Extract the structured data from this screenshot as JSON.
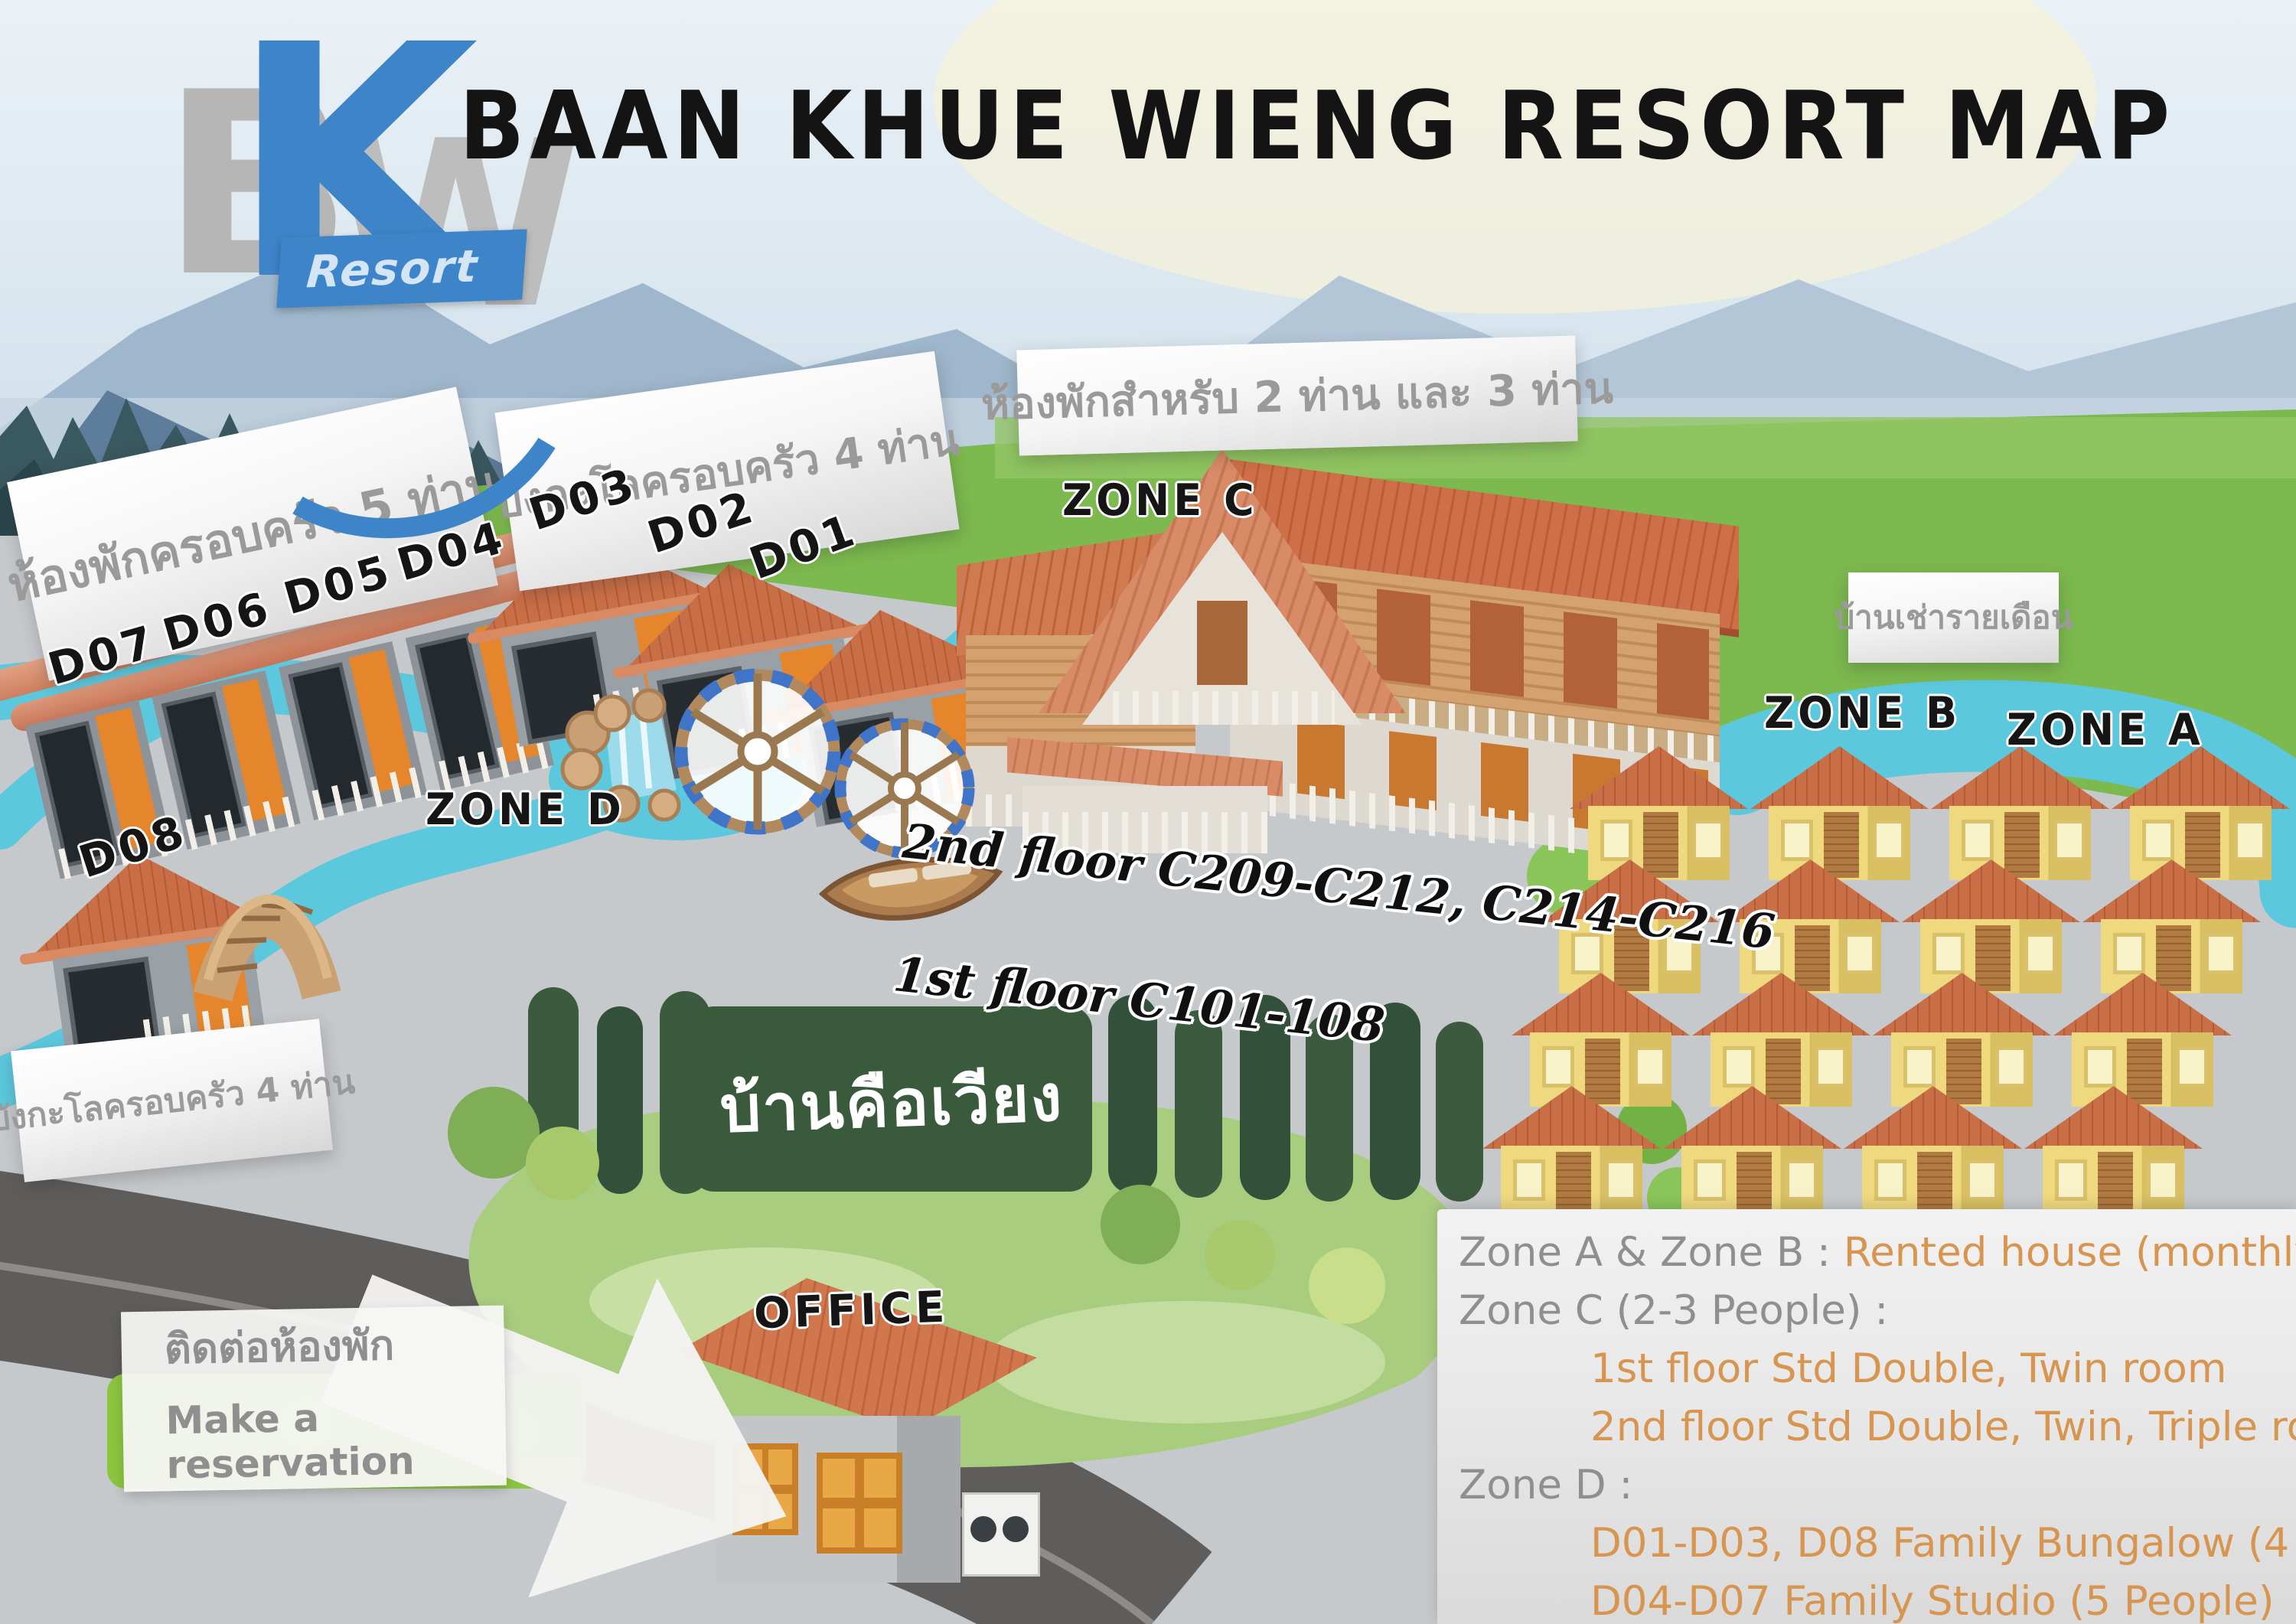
{
  "logo": {
    "b": "B",
    "k": "K",
    "w": "W",
    "resort": "Resort"
  },
  "title": "BAAN KHUE WIENG RESORT MAP",
  "banners": {
    "family_room_5": "ห้องพักครอบครัว 5 ท่าน",
    "bungalow_4_top": "บังกะโลครอบครัว 4 ท่าน",
    "rooms_2_3": "ห้องพักสำหรับ 2 ท่าน และ 3 ท่าน",
    "monthly_rental": "บ้านเช่ารายเดือน",
    "bungalow_4_left": "บังกะโลครอบครัว 4 ท่าน"
  },
  "zones": {
    "a": "ZONE A",
    "b": "ZONE B",
    "c": "ZONE C",
    "d": "ZONE D"
  },
  "units": {
    "d01": "D01",
    "d02": "D02",
    "d03": "D03",
    "d04": "D04",
    "d05": "D05",
    "d06": "D06",
    "d07": "D07",
    "d08": "D08"
  },
  "office_label": "OFFICE",
  "floor_notes": {
    "second": "2nd floor C209-C212, C214-C216",
    "first": "1st floor C101-108"
  },
  "garden_sign": "บ้านคือเวียง",
  "reservation": {
    "thai": "ติดต่อห้องพัก",
    "english": "Make a reservation"
  },
  "legend": {
    "zone_ab_label": "Zone A & Zone B : ",
    "zone_ab_value": "Rented house (monthly)",
    "zone_c_label": "Zone C (2-3 People) :",
    "zone_c_line1": "1st floor Std Double, Twin room",
    "zone_c_line2": "2nd floor Std Double, Twin, Triple room",
    "zone_d_label": "Zone D :",
    "zone_d_line1": "D01-D03, D08 Family Bungalow (4 People)",
    "zone_d_line2": "D04-D07 Family Studio (5 People)"
  },
  "zone_ab_grid": {
    "rows": 4,
    "cols": 4
  },
  "colors": {
    "accent_blue": "#3d85c8",
    "roof_terracotta": "#c4613c",
    "roof_salmon": "#d88f70",
    "water": "#5cc8de",
    "grass": "#7cb94e",
    "ground": "#c6c9cc",
    "legend_gray": "#8f8f8f",
    "legend_orange": "#d79550"
  }
}
